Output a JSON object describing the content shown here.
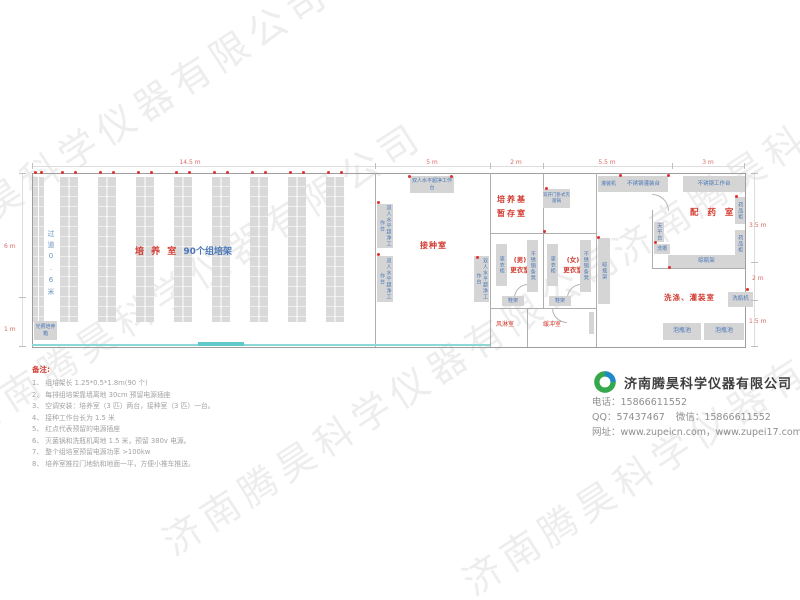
{
  "watermark": "济南腾昊科学仪器有限公司",
  "dims": {
    "top": [
      "14.5 m",
      "5 m",
      "2 m",
      "5.5 m",
      "3 m"
    ],
    "left": [
      "6 m",
      "1 m"
    ],
    "right": [
      "3.5 m",
      "2 m",
      "1.5 m"
    ]
  },
  "rooms": {
    "culture": {
      "name": "培 养 室",
      "racks_label": "90个组培架",
      "aisle": "过道0.6米",
      "incubator": "光照培养箱",
      "rack_rows": 9
    },
    "inoculation": {
      "name": "接种室",
      "bench_top": "双人水平超净工作台",
      "bench_left1": "双人水平超净工作台",
      "bench_left2": "双人水平超净工作台",
      "bench_bottom": "双人水平超净工作台"
    },
    "medium_storage": {
      "name_line1": "培养基",
      "name_line2": "暂存室",
      "sterilizer": "双开门卧式灭菌锅"
    },
    "dressing_male": {
      "name_line1": "(男)",
      "name_line2": "更衣室",
      "locker": "更衣柜",
      "bench": "不锈钢条凳",
      "shoe_rack": "鞋架"
    },
    "dressing_female": {
      "name_line1": "(女)",
      "name_line2": "更衣室",
      "locker": "更衣柜",
      "bench": "不锈钢条凳",
      "shoe_rack": "鞋架"
    },
    "air_shower": {
      "name": "风淋室"
    },
    "buffer": {
      "name": "缓冲室"
    },
    "dispensary": {
      "name": "配 药 室",
      "balance_table": "天平台",
      "sink": "洗槽",
      "cabinet1": "药品柜",
      "cabinet2": "药品柜",
      "bottle_rack": "晾瓶架"
    },
    "washing": {
      "name": "洗涤、灌装室",
      "filler": "灌装机",
      "filling_table": "不锈钢灌装台",
      "work_table": "不锈钢工作台",
      "bottle_rack": "晾瓶架",
      "washer": "洗瓶机",
      "pool1": "泡瓶池",
      "pool2": "泡瓶池"
    }
  },
  "notes": {
    "title": "备注:",
    "items": [
      "1、 组培架长 1.25*0.5*1.8m(90 个)",
      "2、 每排组培架靠墙离地 30cm 预留电源插座",
      "3、 空调安装：培养室（3 匹）两台，接种室（3 匹）一台。",
      "4、 接种工作台长为 1.5 米",
      "5、 红点代表预留的电源插座",
      "6、 灭菌锅和洗瓶机离地 1.5 米，预留 380v 电源。",
      "7、 整个组培室预留电源功率 >100kw",
      "8、 培养室推拉门地轨和地面一平，方便小推车推送。"
    ]
  },
  "company": {
    "name": "济南腾昊科学仪器有限公司",
    "phone": "电话：15866611552",
    "qq": "QQ：57437467",
    "wechat": "微信：15866611552",
    "website": "网址：www.zupeicn.com，www.zupei17.com"
  }
}
